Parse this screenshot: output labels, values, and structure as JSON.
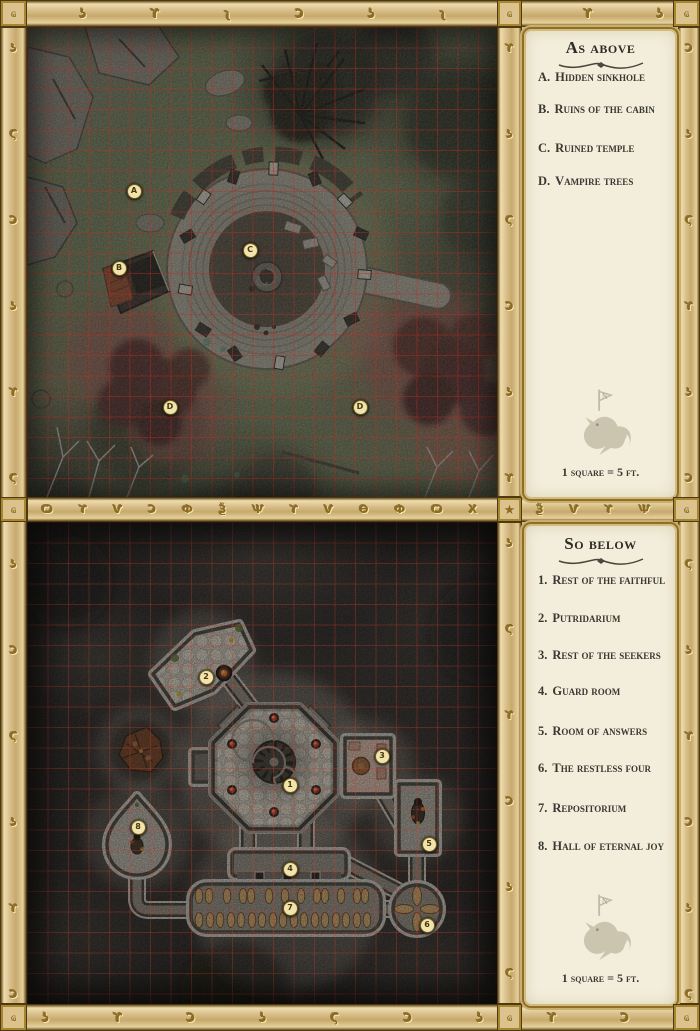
{
  "above_panel": {
    "title": "As above",
    "items": [
      {
        "key": "A.",
        "label": "Hidden sinkhole"
      },
      {
        "key": "B.",
        "label": "Ruins of the cabin"
      },
      {
        "key": "C.",
        "label": "Ruined temple"
      },
      {
        "key": "D.",
        "label": "Vampire trees"
      }
    ],
    "scale_note": "1 square = 5 ft."
  },
  "below_panel": {
    "title": "So below",
    "items": [
      {
        "key": "1.",
        "label": "Rest of the faithful"
      },
      {
        "key": "2.",
        "label": "Putridarium"
      },
      {
        "key": "3.",
        "label": "Rest of the seekers"
      },
      {
        "key": "4.",
        "label": "Guard room"
      },
      {
        "key": "5.",
        "label": "Room of answers"
      },
      {
        "key": "6.",
        "label": "The restless four"
      },
      {
        "key": "7.",
        "label": "Repositorium"
      },
      {
        "key": "8.",
        "label": "Hall of eternal joy"
      }
    ],
    "scale_note": "1 square = 5 ft."
  },
  "sigil": {
    "letter": "N"
  },
  "above_map": {
    "grid_note": "red 5-ft grid",
    "markers": [
      {
        "label": "A",
        "x": 106,
        "y": 163
      },
      {
        "label": "B",
        "x": 91,
        "y": 240
      },
      {
        "label": "C",
        "x": 222,
        "y": 222
      },
      {
        "label": "D",
        "x": 142,
        "y": 379
      },
      {
        "label": "D",
        "x": 332,
        "y": 379
      }
    ]
  },
  "below_map": {
    "grid_note": "red 5-ft grid",
    "markers": [
      {
        "label": "1",
        "x": 262,
        "y": 262
      },
      {
        "label": "2",
        "x": 178,
        "y": 154
      },
      {
        "label": "3",
        "x": 354,
        "y": 233
      },
      {
        "label": "4",
        "x": 262,
        "y": 346
      },
      {
        "label": "5",
        "x": 401,
        "y": 321
      },
      {
        "label": "6",
        "x": 399,
        "y": 402
      },
      {
        "label": "7",
        "x": 262,
        "y": 385
      },
      {
        "label": "8",
        "x": 110,
        "y": 304
      }
    ]
  },
  "frame": {
    "corner_glyph": "ҩ",
    "star_glyph": "★",
    "top_runes": "Ɔ ʅ ʖ ϒ ʅ Ɔ ʖ ʅ Ɔ ϒ ʖ ʅ",
    "middle_runes": "Ѻ Х Ф ʎ Ѻ ϒ Ѵ Ɔ Ф Ѯ Ѱ ϒ Ѵ Ѳ Ф Ѻ Х ʎ Ѯ Ѵ ϒ Ѱ Ѳ Ф Ѻ Х",
    "bottom_runes": "Ͻ ʖ ϒ Ɔ ʖ Ϛ Ɔ ʖ ϒ Ɔ ʖ",
    "left_runes": "ʖ Ϛ Ɔ ʖ ϒ Ϛ ʖ Ɔ Ϛ ʖ ϒ Ɔ ʖ Ϛ",
    "right_runes": "Ɔ ʖ Ϛ ϒ ʖ Ɔ Ϛ ʖ ϒ Ɔ ʖ Ϛ ʖ ϒ",
    "divider_above_runes": "ϒ ʖ Ϛ Ɔ ʖ ϒ Ϛ",
    "divider_below_runes": "ʖ Ϛ ϒ Ɔ ʖ Ϛ ϒ",
    "colors": {
      "border_tan": "#d5ba82",
      "gold": "#8d6a1e",
      "panel_cream": "#f3eedb",
      "grid_red": "#be2d23"
    }
  }
}
